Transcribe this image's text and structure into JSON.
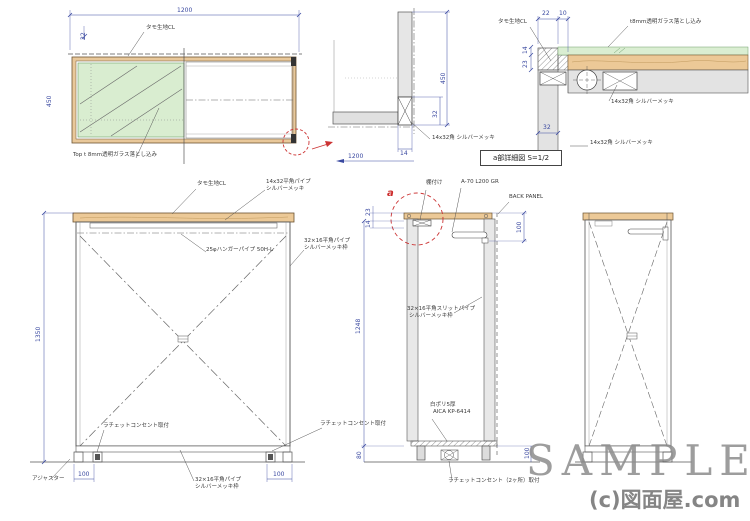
{
  "watermark": {
    "text": "SAMPLE",
    "credit": "(c)図面屋.com"
  },
  "detail_box": {
    "title": "a部詳細図 S=1/2"
  },
  "plan": {
    "dim_width": "1200",
    "dim_height": "450",
    "dim_edge": "22",
    "label_finish": "タモ生地CL",
    "label_glass": "Top t 8mm透明ガラス落とし込み"
  },
  "section": {
    "dim_height": "450",
    "dim_pipe": "32",
    "dim_thickness": "14",
    "dim_width": "1200",
    "label_pipe": "14x32角 シルバーメッキ"
  },
  "detail": {
    "dim_a": "22",
    "dim_b": "10",
    "dim_c": "14",
    "dim_d": "23",
    "dim_e": "32",
    "label_glass": "t8mm透明ガラス落とし込み",
    "label_finish": "タモ生地CL",
    "label_pipe_mid": "14x32角 シルバーメッキ",
    "label_pipe_bottom": "14x32角 シルバーメッキ"
  },
  "elevation": {
    "dim_height": "1350",
    "dim_foot_left": "100",
    "dim_foot_right": "100",
    "label_finish": "タモ生地CL",
    "label_top_pipe1": "14x32平角パイプ",
    "label_top_pipe2": "シルバーメッキ",
    "label_hanger": "25φハンガーパイプ 50H-L",
    "label_frame1": "32×16平角パイプ",
    "label_frame2": "シルバーメッキ枠",
    "label_outlet_left": "ラチェットコンセント取付",
    "label_outlet_right": "ラチェットコンセント取付",
    "label_adjuster": "アジャスター",
    "label_base1": "32×16平角パイプ",
    "label_base2": "シルバーメッキ枠"
  },
  "side_section": {
    "marker": "a",
    "dim_top1": "23",
    "dim_top2": "14",
    "dim_height": "1248",
    "dim_base": "80",
    "dim_bracket": "100",
    "dim_bottom": "100",
    "label_bracket": "棚付け",
    "label_hanger_code": "A-70 L200 GR",
    "label_back_panel": "BACK PANEL",
    "label_slit1": "32×16平角スリットパイプ",
    "label_slit2": "シルバーメッキ枠",
    "label_poly1": "白ポリ5厚",
    "label_poly2": "AICA KP-6414",
    "label_outlet": "ラチェットコンセント（2ヶ所）取付"
  }
}
